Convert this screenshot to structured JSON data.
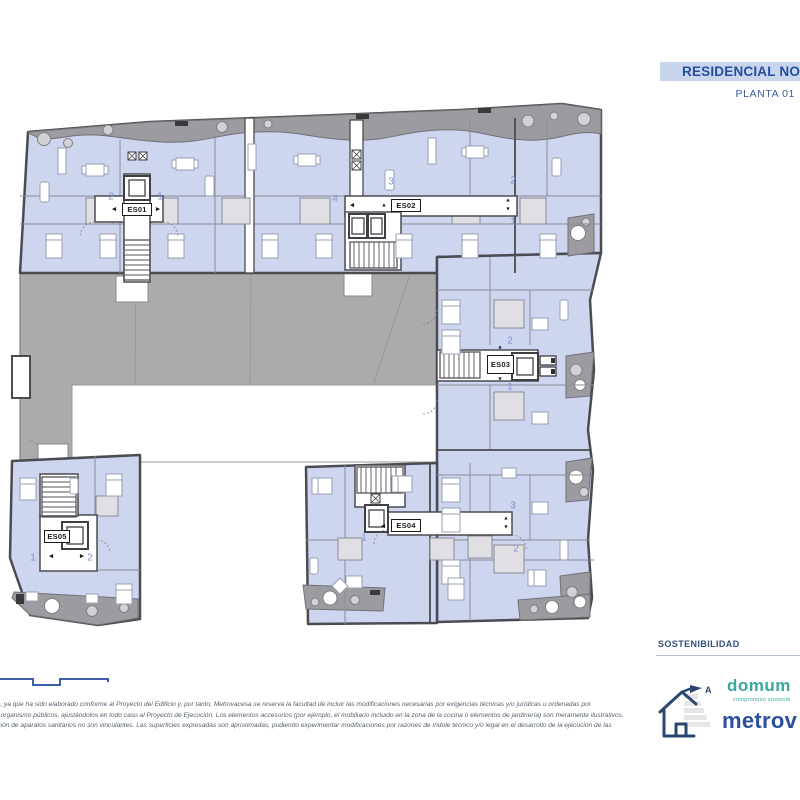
{
  "header": {
    "project_title": "RESIDENCIAL NOVA",
    "floor_label": "PLANTA 01"
  },
  "plan": {
    "stair_cores": [
      {
        "id": "ES01",
        "x": 122,
        "y": 203,
        "w": 30,
        "h": 13,
        "arrows": [
          {
            "d": "left",
            "x": 114,
            "y": 210
          },
          {
            "d": "right",
            "x": 158,
            "y": 210
          }
        ]
      },
      {
        "id": "ES02",
        "x": 391,
        "y": 199,
        "w": 30,
        "h": 13,
        "arrows": [
          {
            "d": "left",
            "x": 352,
            "y": 206
          },
          {
            "d": "up",
            "x": 384,
            "y": 206
          },
          {
            "d": "up",
            "x": 508,
            "y": 201
          },
          {
            "d": "down",
            "x": 508,
            "y": 210
          }
        ]
      },
      {
        "id": "ES03",
        "x": 487,
        "y": 355,
        "w": 27,
        "h": 19,
        "arrows": [
          {
            "d": "up",
            "x": 500,
            "y": 348
          },
          {
            "d": "down",
            "x": 500,
            "y": 380
          }
        ]
      },
      {
        "id": "ES04",
        "x": 391,
        "y": 519,
        "w": 30,
        "h": 13,
        "arrows": [
          {
            "d": "left",
            "x": 383,
            "y": 527
          },
          {
            "d": "up",
            "x": 506,
            "y": 519
          },
          {
            "d": "down",
            "x": 506,
            "y": 528
          }
        ]
      },
      {
        "id": "ES05",
        "x": 44,
        "y": 530,
        "w": 26,
        "h": 13,
        "arrows": [
          {
            "d": "left",
            "x": 51,
            "y": 557
          },
          {
            "d": "right",
            "x": 82,
            "y": 557
          }
        ]
      }
    ],
    "units": [
      {
        "label": "2",
        "x": 111,
        "y": 197
      },
      {
        "label": "1",
        "x": 160,
        "y": 197
      },
      {
        "label": "4",
        "x": 335,
        "y": 199
      },
      {
        "label": "3",
        "x": 391,
        "y": 182
      },
      {
        "label": "2",
        "x": 513,
        "y": 181
      },
      {
        "label": "1",
        "x": 513,
        "y": 222
      },
      {
        "label": "2",
        "x": 510,
        "y": 341
      },
      {
        "label": "1",
        "x": 510,
        "y": 387
      },
      {
        "label": "1",
        "x": 364,
        "y": 538
      },
      {
        "label": "3",
        "x": 513,
        "y": 506
      },
      {
        "label": "2",
        "x": 516,
        "y": 549
      },
      {
        "label": "1",
        "x": 33,
        "y": 558
      },
      {
        "label": "2",
        "x": 90,
        "y": 558
      }
    ]
  },
  "footer": {
    "sustainability_label": "SOSTENIBILIDAD",
    "energy_rating_letter": "A",
    "brand_domum": "domum",
    "brand_domum_tagline": "compromiso sostenib",
    "brand_metrovacesa": "metrov",
    "disclaimer_lines": [
      "tivo, ya que ha sido elaborado conforme al Proyecto del Edificio y, por tanto, Metrovacesa se reserva la facultad de incluir las modificaciones necesarias por exigencias técnicas y/o jurídicas u ordenadas por",
      "s u organismo públicos, ajustándolos en todo caso al Proyecto de Ejecución. Los elementos accesorios (por ejemplo, el mobiliario incluido en la zona de la cocina o elementos de jardinería) son meramente ilustrativos.",
      "bución de aparatos sanitarios no son vinculantes. Las superficies expresadas son aproximadas, pudiendo experimentar modificaciones por razones de índole técnico y/o legal en el desarrollo de la ejecución de las"
    ]
  },
  "colors": {
    "title_bg": "#c9d5ec",
    "title_text": "#20509f",
    "apartment_fill": "#cdd5ef",
    "courtyard_gray": "#ababab",
    "terrace_gray": "#9c9ca0",
    "wall": "#4b4b52",
    "unit_number_blue": "#7d92cc",
    "brand_teal": "#3aa79c",
    "brand_navy": "#2d4f9f"
  }
}
